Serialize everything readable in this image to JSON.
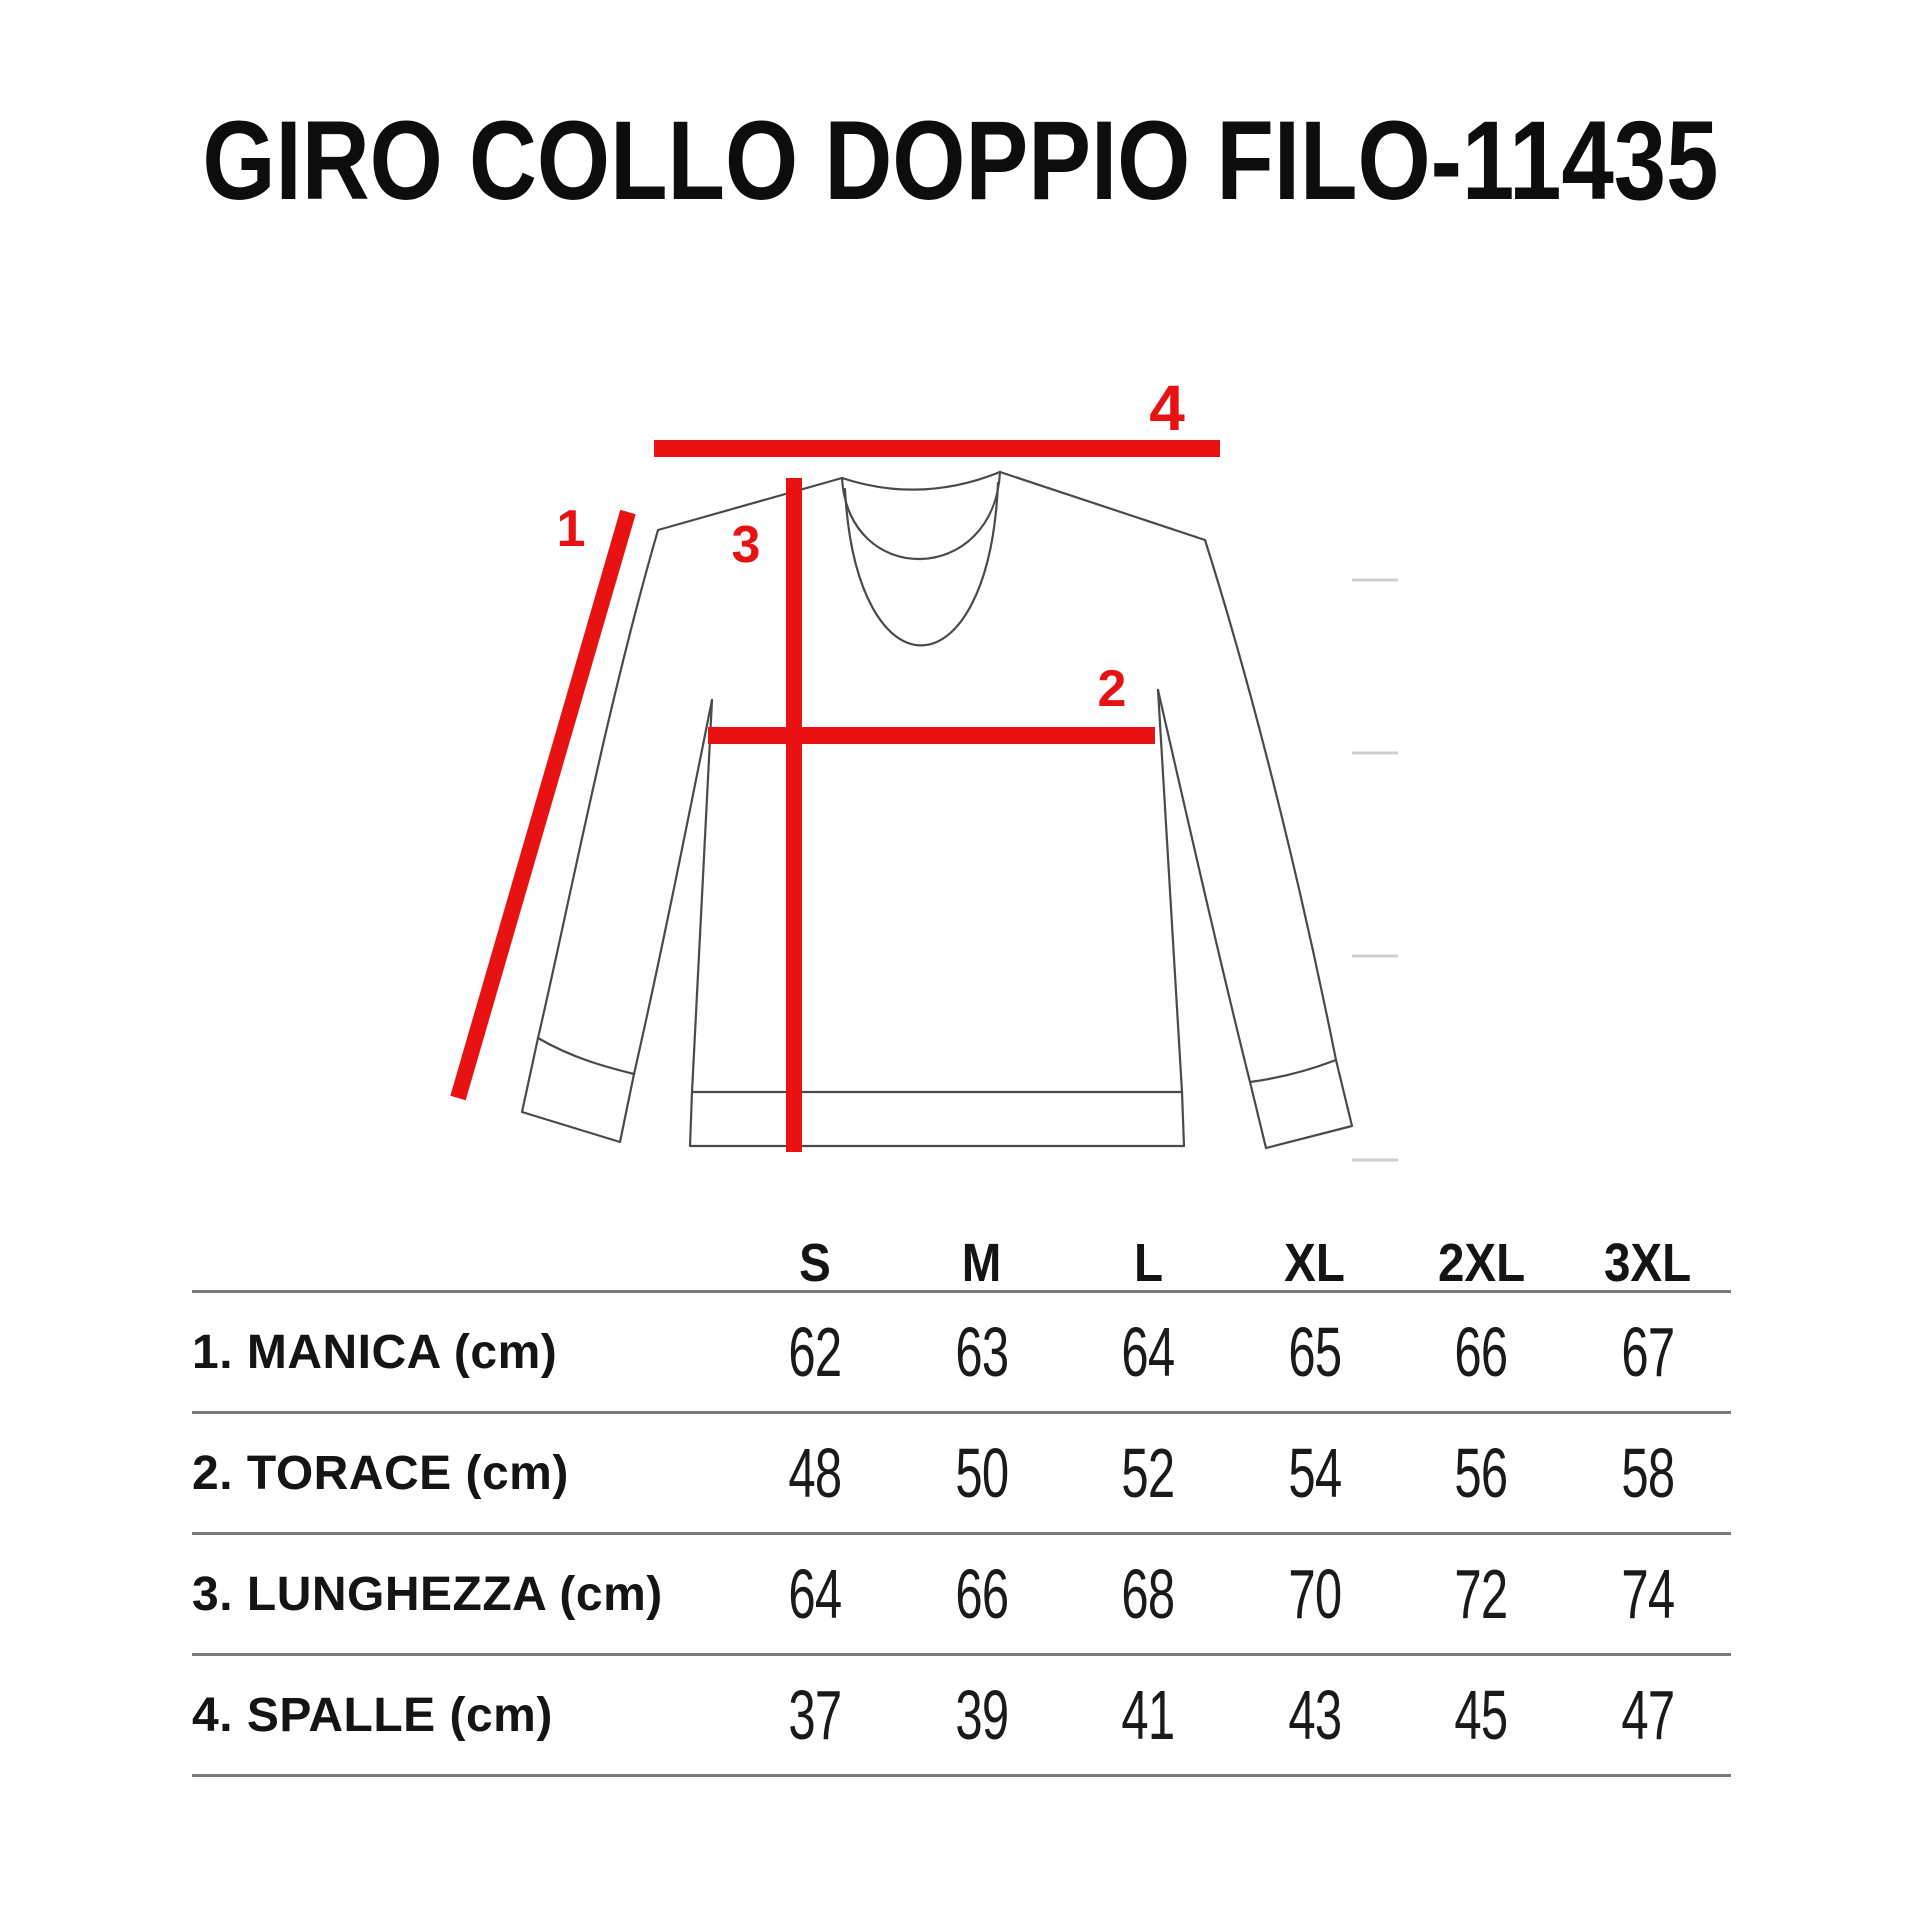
{
  "title": "GIRO COLLO DOPPIO FILO-11435",
  "diagram": {
    "markers": {
      "m1": "1",
      "m2": "2",
      "m3": "3",
      "m4": "4"
    }
  },
  "size_table": {
    "size_headers": [
      "S",
      "M",
      "L",
      "XL",
      "2XL",
      "3XL"
    ],
    "rows": [
      {
        "label": "1. MANICA (cm)",
        "values": [
          "62",
          "63",
          "64",
          "65",
          "66",
          "67"
        ]
      },
      {
        "label": "2. TORACE (cm)",
        "values": [
          "48",
          "50",
          "52",
          "54",
          "56",
          "58"
        ]
      },
      {
        "label": "3. LUNGHEZZA (cm)",
        "values": [
          "64",
          "66",
          "68",
          "70",
          "72",
          "74"
        ]
      },
      {
        "label": "4. SPALLE (cm)",
        "values": [
          "37",
          "39",
          "41",
          "43",
          "45",
          "47"
        ]
      }
    ]
  },
  "colors": {
    "accent_red": "#e81212",
    "text": "#141414",
    "rule_gray": "#7b7b7b",
    "outline_gray": "#4a4a4a",
    "tick_gray": "#cfcfcf",
    "background": "#ffffff"
  },
  "chart_data": {
    "type": "table",
    "title": "GIRO COLLO DOPPIO FILO-11435",
    "units": "cm",
    "columns": [
      "S",
      "M",
      "L",
      "XL",
      "2XL",
      "3XL"
    ],
    "rows": [
      {
        "label": "1. MANICA (cm)",
        "values": [
          62,
          63,
          64,
          65,
          66,
          67
        ]
      },
      {
        "label": "2. TORACE (cm)",
        "values": [
          48,
          50,
          52,
          54,
          56,
          58
        ]
      },
      {
        "label": "3. LUNGHEZZA (cm)",
        "values": [
          64,
          66,
          68,
          70,
          72,
          74
        ]
      },
      {
        "label": "4. SPALLE (cm)",
        "values": [
          37,
          39,
          41,
          43,
          45,
          47
        ]
      }
    ],
    "measurement_markers": [
      {
        "id": "1",
        "name": "MANICA (sleeve)"
      },
      {
        "id": "2",
        "name": "TORACE (chest)"
      },
      {
        "id": "3",
        "name": "LUNGHEZZA (length)"
      },
      {
        "id": "4",
        "name": "SPALLE (shoulders)"
      }
    ]
  }
}
